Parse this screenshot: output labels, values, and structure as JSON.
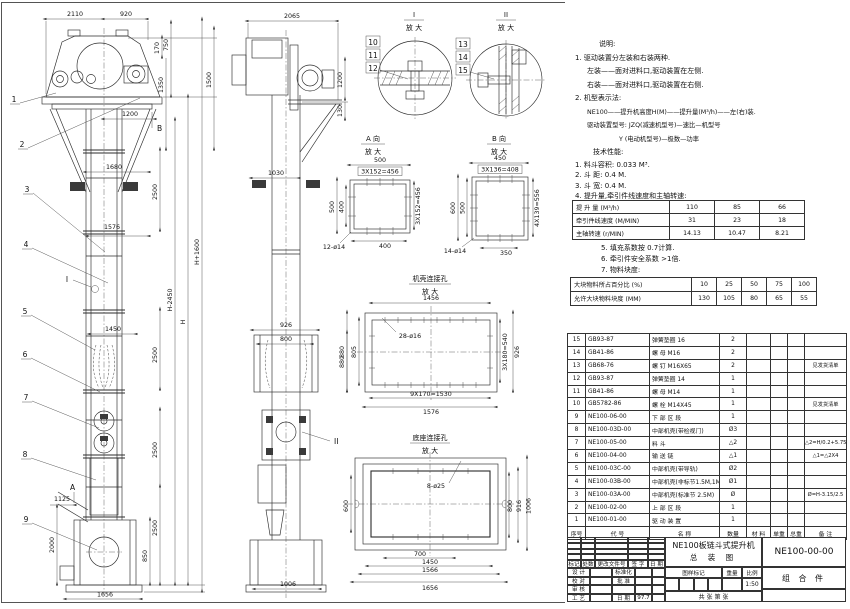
{
  "sheet": {
    "title_line1": "NE100板链斗式提升机",
    "title_line2": "总  装  图",
    "drawing_no": "NE100-00-00",
    "assembly": "组 合 件",
    "scale": "1:50",
    "date": "97.7",
    "sheet_label": "共    张  第    张"
  },
  "titleblock": {
    "rev_headers": [
      "标记",
      "处数",
      "更改文件号",
      "签 字",
      "日 期"
    ],
    "staff_rows": [
      [
        "设 计",
        "",
        "标准化",
        "",
        ""
      ],
      [
        "校 对",
        "",
        "批 准",
        "",
        ""
      ],
      [
        "审 核",
        "",
        "",
        "",
        ""
      ],
      [
        "工 艺",
        "",
        "日 期",
        "97.7",
        ""
      ]
    ],
    "mark_label": "图样标记",
    "weight_label": "重量",
    "scale_label": "比例"
  },
  "notes": {
    "heading": "说明:",
    "lines": [
      "1. 驱动装置分左装和右装两种.",
      "左装——面对进料口,驱动装置在左侧.",
      "右装——面对进料口,驱动装置在右侧.",
      "2. 机型表示法:",
      "NE100——提升机高度H(M)——提升量(M³/h)——左(右)装.",
      "驱动装置型号: JZQ(减速机型号)—速比—机型号",
      "Y (电动机型号)—极数—功率"
    ],
    "tech_heading": "技术性能:",
    "tech": [
      "1. 料斗容积: 0.033 M³.",
      "2. 斗    距: 0.4 M.",
      "3. 斗    宽: 0.4 M.",
      "4. 提升量,牵引件线速度和主轴转速:"
    ]
  },
  "spec_table": {
    "rows": [
      {
        "label": "提 升 量  (M³/h)",
        "values": [
          "110",
          "85",
          "66"
        ]
      },
      {
        "label": "牵引件线速度 (M/MIN)",
        "values": [
          "31",
          "23",
          "18"
        ]
      },
      {
        "label": "主轴转速 (r/MIN)",
        "values": [
          "14.13",
          "10.47",
          "8.21"
        ]
      }
    ]
  },
  "notes2": [
    "5. 填充系数按 0.7计算.",
    "6. 牵引件安全系数 >1倍.",
    "7. 物料块度:"
  ],
  "lump_table": {
    "rows": [
      {
        "label": "大块物料所占百分比 (%)",
        "values": [
          "10",
          "25",
          "50",
          "75",
          "100"
        ]
      },
      {
        "label": "允许大块物料块度 (MM)",
        "values": [
          "130",
          "105",
          "80",
          "65",
          "55"
        ]
      }
    ]
  },
  "bom": {
    "headers": [
      "序号",
      "代  号",
      "名    称",
      "数量",
      "材  料",
      "单重",
      "总重",
      "备  注"
    ],
    "rows": [
      {
        "no": "15",
        "code": "GB93-87",
        "name": "弹簧垫圈  16",
        "qty": "2",
        "remark": ""
      },
      {
        "no": "14",
        "code": "GB41-86",
        "name": "螺 母  M16",
        "qty": "2",
        "remark": ""
      },
      {
        "no": "13",
        "code": "GB68-76",
        "name": "螺 钉  M16X65",
        "qty": "2",
        "remark": "见发货清单"
      },
      {
        "no": "12",
        "code": "GB93-87",
        "name": "弹簧垫圈  14",
        "qty": "1",
        "remark": ""
      },
      {
        "no": "11",
        "code": "GB41-86",
        "name": "螺 母  M14",
        "qty": "1",
        "remark": ""
      },
      {
        "no": "10",
        "code": "GB5782-86",
        "name": "螺 栓  M14X45",
        "qty": "1",
        "remark": "见发货清单"
      },
      {
        "no": "9",
        "code": "NE100-06-00",
        "name": "下 部 区 段",
        "qty": "1",
        "remark": ""
      },
      {
        "no": "8",
        "code": "NE100-03D-00",
        "name": "中部机壳(带检视门)",
        "qty": "Ø3",
        "remark": ""
      },
      {
        "no": "7",
        "code": "NE100-05-00",
        "name": "料  斗",
        "qty": "△2",
        "remark": "△2=H/0.2+5.75"
      },
      {
        "no": "6",
        "code": "NE100-04-00",
        "name": "输 送 链",
        "qty": "△1",
        "remark": "△1=△2X4"
      },
      {
        "no": "5",
        "code": "NE100-03C-00",
        "name": "中部机壳(带导轨)",
        "qty": "Ø2",
        "remark": ""
      },
      {
        "no": "4",
        "code": "NE100-03B-00",
        "name": "中部机壳(非标节1.5M,1M)",
        "qty": "Ø1",
        "remark": ""
      },
      {
        "no": "3",
        "code": "NE100-03A-00",
        "name": "中部机壳(标准节 2.5M)",
        "qty": "Ø",
        "remark": "Ø=H-3.15/2.5"
      },
      {
        "no": "2",
        "code": "NE100-02-00",
        "name": "上 部 区 段",
        "qty": "1",
        "remark": ""
      },
      {
        "no": "1",
        "code": "NE100-01-00",
        "name": "驱 动 装 置",
        "qty": "1",
        "remark": ""
      }
    ]
  },
  "front_dims": [
    "2110",
    "920",
    "170",
    "750",
    "1350",
    "1500",
    "1200",
    "1680",
    "2500",
    "1576",
    "1450",
    "2500",
    "H-2450",
    "H",
    "H+1600",
    "2500",
    "2500",
    "1125",
    "2000",
    "850",
    "1656"
  ],
  "side_dims": [
    "2065",
    "1200",
    "130",
    "1030",
    "926",
    "800",
    "880",
    "1006"
  ],
  "front_balloons": [
    "1",
    "2",
    "3",
    "4",
    "5",
    "6",
    "7",
    "8",
    "9"
  ],
  "labels": {
    "A": "A",
    "B": "B",
    "I": "I",
    "II": "II"
  },
  "detail1": {
    "num": "I",
    "mag": "放 大",
    "balloons": [
      "10",
      "11",
      "12"
    ]
  },
  "detail2": {
    "num": "II",
    "mag": "放 大",
    "balloons": [
      "13",
      "14",
      "15"
    ]
  },
  "viewA": {
    "title": "A 向",
    "mag": "放 大",
    "top1": "500",
    "top2": "3X152=456",
    "left1": "500",
    "left2": "400",
    "right1": "3X152=456",
    "bottom1": "400",
    "callout": "12-ø14"
  },
  "viewB": {
    "title": "B 向",
    "mag": "放 大",
    "top1": "450",
    "top2": "3X136=408",
    "left1": "600",
    "left2": "500",
    "right1": "4X139=556",
    "bottom1": "350",
    "callout": "14-ø14"
  },
  "caseDetail": {
    "title": "机壳连接孔",
    "mag": "放 大",
    "top1": "1456",
    "callout": "28-ø16",
    "left1": "880",
    "left2": "805",
    "right1": "3X180=540",
    "right2": "926",
    "bottom1": "9X170=1530",
    "bottom2": "1576"
  },
  "baseDetail": {
    "title": "底座连接孔",
    "mag": "放 大",
    "callout": "8-ø25",
    "left1": "600",
    "right1": "800",
    "right2": "916",
    "right3": "1006",
    "bottom1": "700",
    "bottom2": "1450",
    "bottom3": "1566",
    "bottom4": "1656"
  }
}
